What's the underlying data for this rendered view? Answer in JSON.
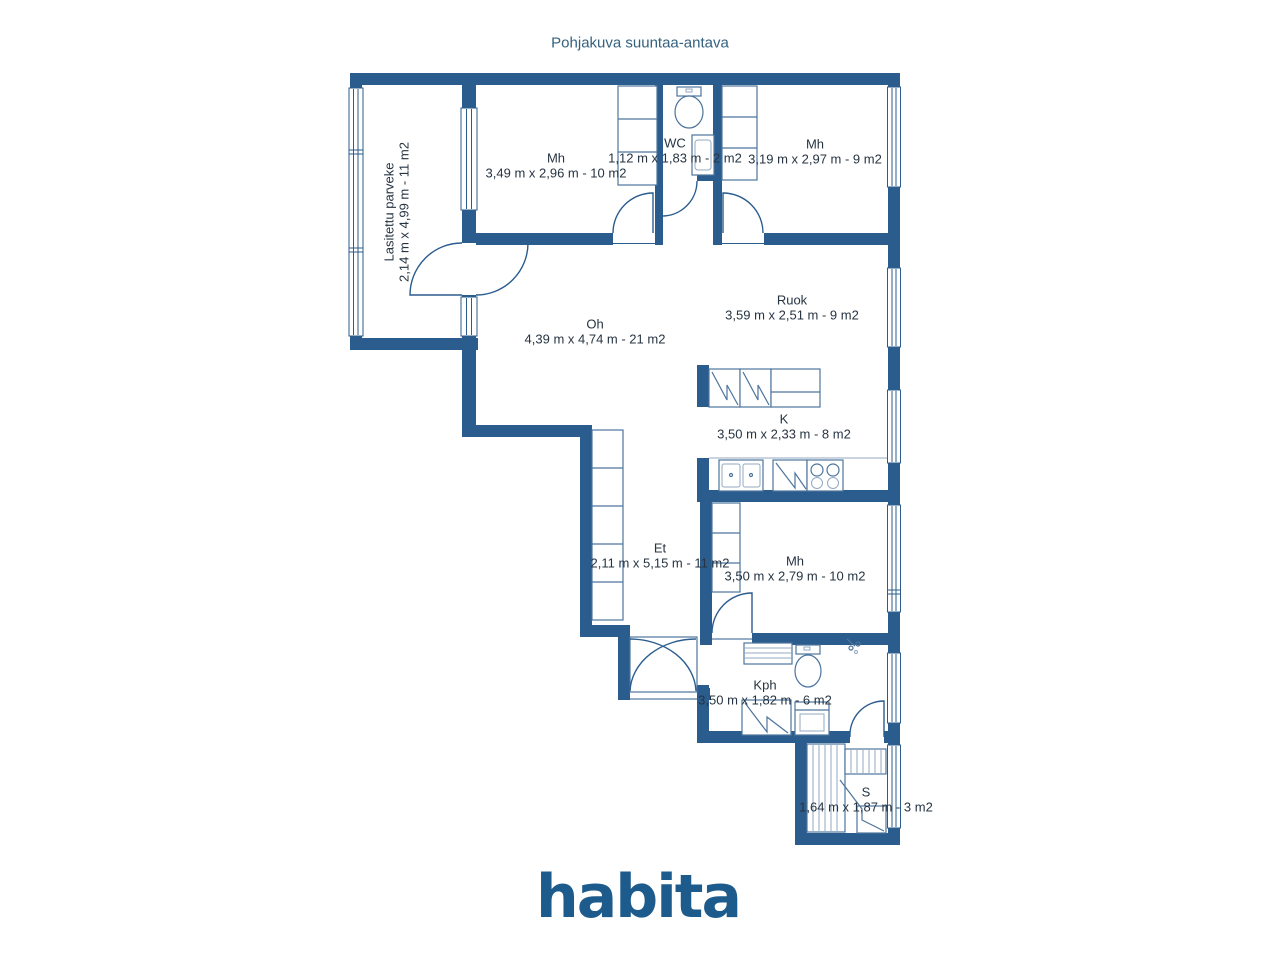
{
  "title": "Pohjakuva suuntaa-antava",
  "rooms": [
    {
      "id": "parveke",
      "name": "Lasitettu parveke",
      "dims": "2,14 m x 4,99 m - 11 m2"
    },
    {
      "id": "mh1",
      "name": "Mh",
      "dims": "3,49 m x 2,96 m - 10 m2"
    },
    {
      "id": "wc",
      "name": "WC",
      "dims": "1,12 m x 1,83 m - 2 m2"
    },
    {
      "id": "mh2",
      "name": "Mh",
      "dims": "3,19 m x 2,97 m - 9 m2"
    },
    {
      "id": "oh",
      "name": "Oh",
      "dims": "4,39 m x 4,74 m - 21 m2"
    },
    {
      "id": "ruok",
      "name": "Ruok",
      "dims": "3,59 m x 2,51 m - 9 m2"
    },
    {
      "id": "k",
      "name": "K",
      "dims": "3,50 m x 2,33 m - 8 m2"
    },
    {
      "id": "et",
      "name": "Et",
      "dims": "2,11 m x 5,15 m - 11 m2"
    },
    {
      "id": "mh3",
      "name": "Mh",
      "dims": "3,50 m x 2,79 m - 10 m2"
    },
    {
      "id": "kph",
      "name": "Kph",
      "dims": "3,50 m x 1,82 m - 6 m2"
    },
    {
      "id": "s",
      "name": "S",
      "dims": "1,64 m x 1,87 m - 3 m2"
    }
  ],
  "logo": {
    "text": "habita"
  },
  "colors": {
    "wall": "#2b5c8e",
    "title": "#33617f",
    "label": "#263442",
    "logo": "#1d5b8c",
    "fixture": "#4d749c",
    "hatch": "#93a9c0"
  }
}
